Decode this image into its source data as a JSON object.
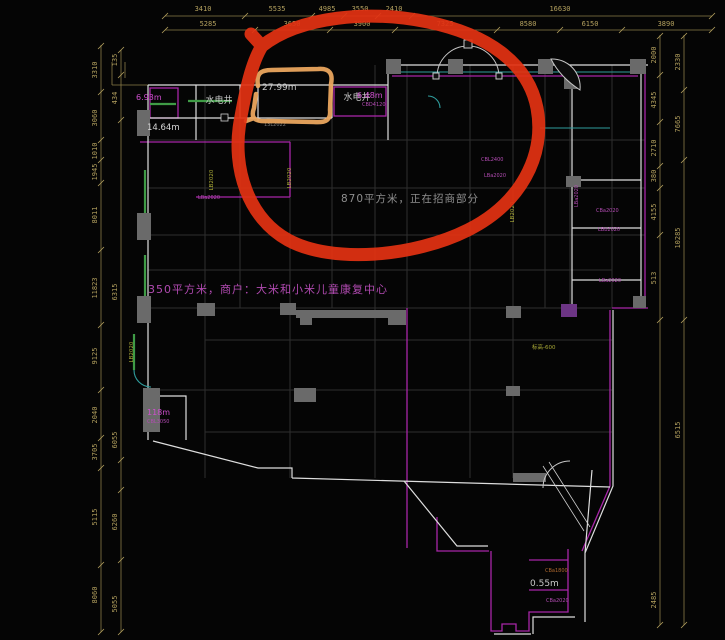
{
  "colors": {
    "background": "#050505",
    "dimension_text": "#b3a05e",
    "wall_white": "#dedede",
    "beam_magenta": "#a826a8",
    "grid_gray": "#2e2e2e",
    "column_gray": "#6a6a6a",
    "column_purple": "#6d3585",
    "wall_green": "#3f9b46",
    "line_teal": "#2f9d9d",
    "annotation_red": "#e23212",
    "annotation_orange": "#eaa55e"
  },
  "labels": {
    "wellLeft": "水电井",
    "wellRight": "水电井",
    "areaMain": "870平方米，正在招商部分",
    "areaTenant": "350平方米，商户：大米和小米儿童康复中心",
    "m693": "6.93m",
    "m1464": "14.64m",
    "m2799": "27.99m",
    "m648": "6.48m",
    "m118": "118m",
    "m055": "0.55m",
    "elev": "标高-600",
    "cbd4120": "CBD4120",
    "cbl3050": "CBL3050",
    "cbl2400": "CBL2400",
    "cba1800": "CBa1800",
    "cba2020": "CBa2020",
    "lba2020": "LBa2020",
    "lbb2020": "LBb2020",
    "lb2020": "LB2020",
    "l13": "13L2022"
  },
  "dims": {
    "top1": [
      "3410",
      "5535",
      "4985",
      "3550",
      "2410",
      "16630"
    ],
    "top2": [
      "5285",
      "3650",
      "3900",
      "7325",
      "8580",
      "6150",
      "3890"
    ],
    "left_outer": [
      "3310",
      "3060",
      "1010",
      "1945",
      "8011",
      "11823",
      "9125",
      "2040",
      "3705",
      "5115",
      "8060"
    ],
    "left_inner": [
      "135",
      "434",
      "6315",
      "6055",
      "6260",
      "5055"
    ],
    "right_outer": [
      "2000",
      "4345",
      "2710",
      "380",
      "4155",
      "513",
      "2485"
    ],
    "right_inner": [
      "2330",
      "7665",
      "10285",
      "6515"
    ]
  }
}
